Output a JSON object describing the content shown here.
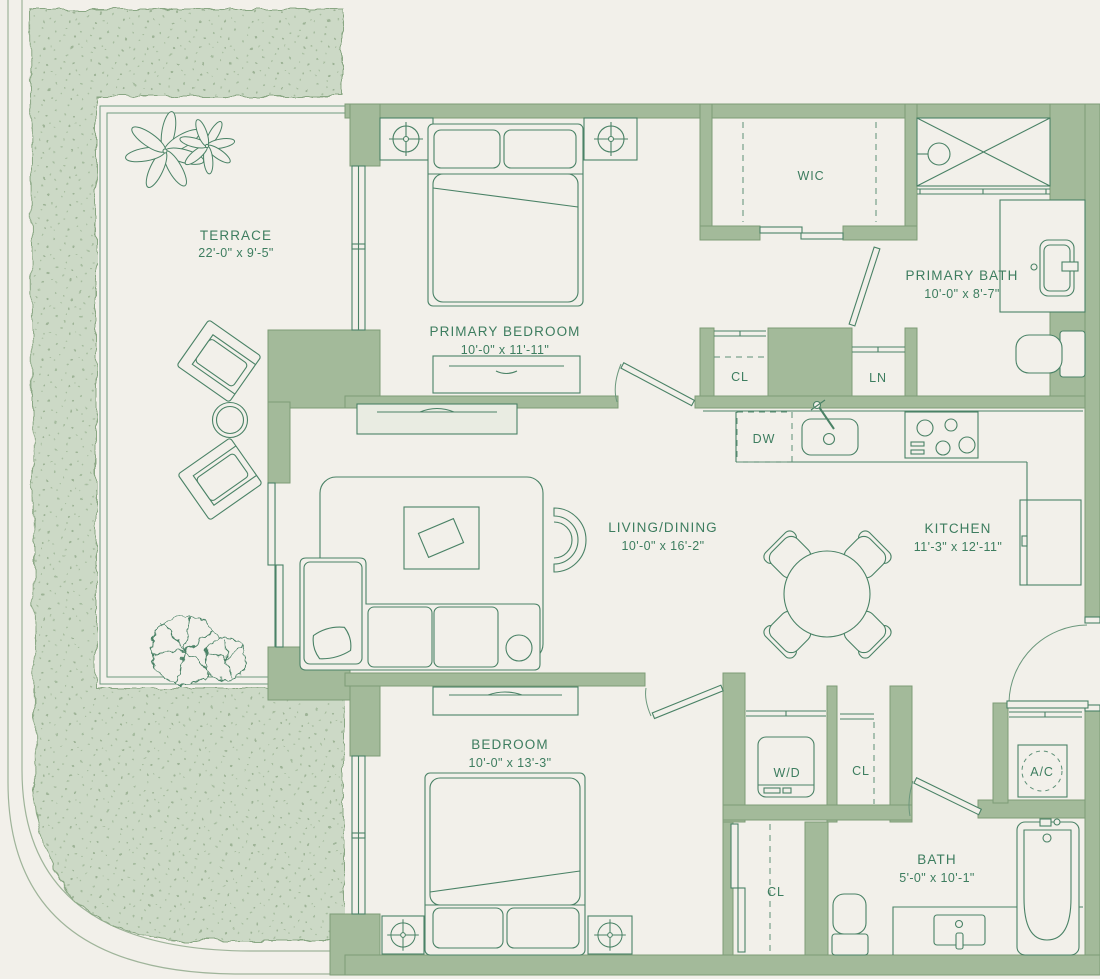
{
  "palette": {
    "background": "#f2f0ea",
    "wall": "#a3ba9a",
    "wall_outline": "#7d9c77",
    "landscape": "#ccd9c6",
    "landscape_dot": "#a6bc9f",
    "line": "#4a8266",
    "text": "#3d7d5f"
  },
  "rooms": {
    "terrace": {
      "name": "TERRACE",
      "dims": "22'-0\" x 9'-5\""
    },
    "primary_bedroom": {
      "name": "PRIMARY BEDROOM",
      "dims": "10'-0\" x 11'-11\""
    },
    "wic": {
      "name": "WIC"
    },
    "primary_bath": {
      "name": "PRIMARY BATH",
      "dims": "10'-0\" x 8'-7\""
    },
    "living_dining": {
      "name": "LIVING/DINING",
      "dims": "10'-0\" x 16'-2\""
    },
    "kitchen": {
      "name": "KITCHEN",
      "dims": "11'-3\" x 12'-11\""
    },
    "bedroom": {
      "name": "BEDROOM",
      "dims": "10'-0\" x 13'-3\""
    },
    "bath": {
      "name": "BATH",
      "dims": "5'-0\" x 10'-1\""
    }
  },
  "closets": {
    "hall_closet": "CL",
    "linen_closet": "LN",
    "laundry_closet": "CL",
    "entry_hall_closet": "CL"
  },
  "appliances": {
    "dishwasher": "DW",
    "washer_dryer": "W/D",
    "air_conditioner": "A/C"
  }
}
